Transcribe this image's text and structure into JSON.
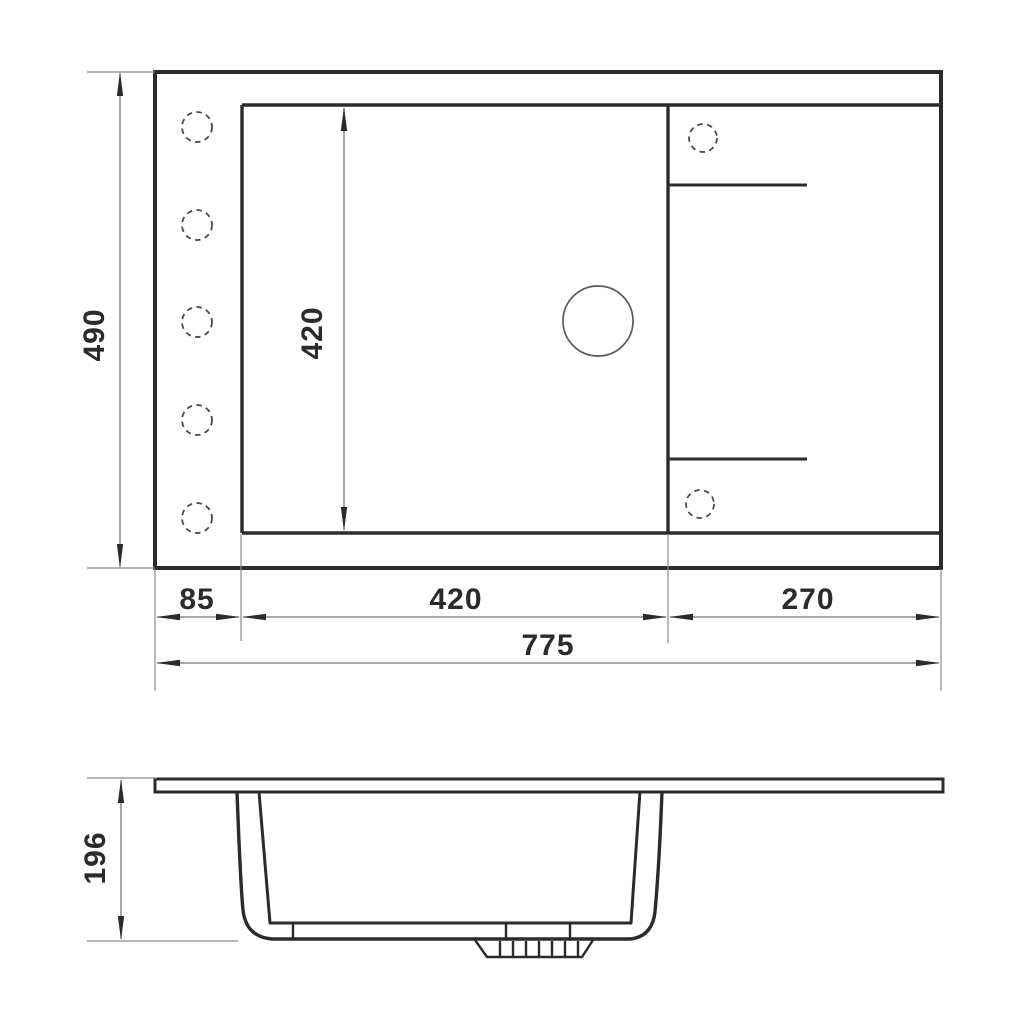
{
  "drawing": {
    "views": {
      "top": {
        "dims": {
          "depth": "490",
          "bowl_depth": "420",
          "left_offset": "85",
          "bowl_width": "420",
          "right_section": "270",
          "overall_width": "775"
        },
        "features": {
          "left_mounting_hole_count": 5,
          "right_mounting_hole_count": 2,
          "faucet_hole_count": 1
        }
      },
      "side": {
        "dims": {
          "height": "196"
        }
      }
    },
    "colors": {
      "line": "#2b2b2b",
      "dimension_line": "#767676",
      "label": "#2b2b2b",
      "background": "#ffffff"
    }
  }
}
